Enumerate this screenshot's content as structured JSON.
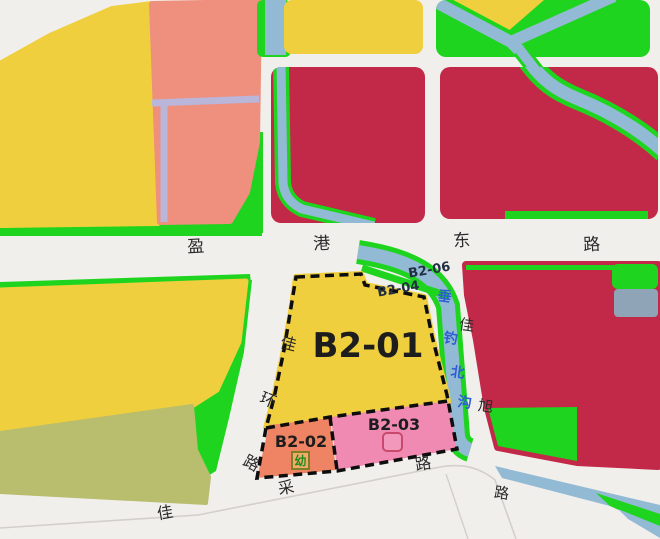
{
  "map": {
    "colors": {
      "background": "#f1efec",
      "yellow": "#f0cf3e",
      "salmon": "#ef8f7d",
      "orange": "#ef8464",
      "pink": "#f08ab2",
      "crimson": "#c22848",
      "green": "#1ed41e",
      "water": "#92bad4",
      "olive": "#b9bd6e",
      "lavender": "#b9b6da",
      "gray_blue": "#90a4b8",
      "dash_black": "#0d0d0d",
      "road_line": "#d3cfca",
      "text_dark": "#2a2a2a",
      "text_parcel_small": "#233043",
      "text_water": "#2e5ed2",
      "kid_green": "#1f8c1f",
      "kid_border": "#7e7e23",
      "school_icon_stroke": "#c8496b"
    },
    "roads": {
      "yinggang_east_road": {
        "name": "盈港东路",
        "chars": [
          "盈",
          "港",
          "东",
          "路"
        ]
      },
      "jiahuan_road": {
        "name": "佳环路",
        "chars": [
          "佳",
          "环",
          "路"
        ]
      },
      "jiacai_road": {
        "name": "佳采路",
        "chars": [
          "佳",
          "采",
          "路"
        ]
      },
      "jiaxu_road": {
        "name": "佳旭路",
        "chars": [
          "佳",
          "旭",
          "路"
        ]
      }
    },
    "waterway": {
      "name": "垂钓北沟",
      "chars": [
        "垂",
        "钓",
        "北",
        "沟"
      ]
    },
    "parcels": {
      "b2_01": "B2-01",
      "b2_02": "B2-02",
      "b2_03": "B2-03",
      "b2_04": "B2-04",
      "b2_06": "B2-06"
    },
    "icons": {
      "kindergarten": "幼"
    }
  }
}
